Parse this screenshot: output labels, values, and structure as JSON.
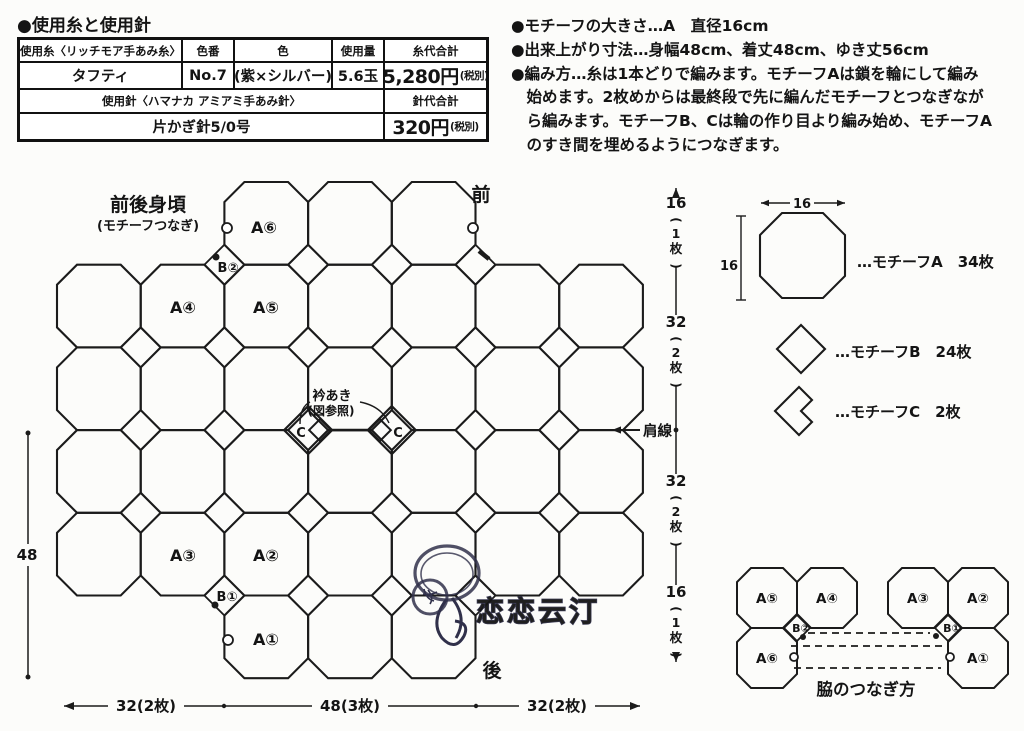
{
  "materials": {
    "title": "●使用糸と使用針",
    "headers": [
      "使用糸〈リッチモア手あみ糸〉",
      "色番",
      "色",
      "使用量",
      "糸代合計"
    ],
    "yarn": {
      "name": "タフティ",
      "color_no": "No.7",
      "color": "(紫×シルバー)",
      "amount": "5.6玉",
      "cost": "5,280円",
      "cost_note": "(税別)"
    },
    "needle": {
      "header": "使用針〈ハマナカ アミアミ手あみ針〉",
      "cost_header": "針代合計",
      "name": "片かぎ針5/0号",
      "cost": "320円",
      "cost_note": "(税別)"
    }
  },
  "notes": {
    "lines": [
      "●モチーフの大きさ…A　直径16cm",
      "●出来上がり寸法…身幅48cm、着丈48cm、ゆき丈56cm",
      "●編み方…糸は1本どりで編みます。モチーフAは鎖を輪にして編み",
      "　始めます。2枚めからは最終段で先に編んだモチーフとつなぎなが",
      "　ら編みます。モチーフB、Cは輪の作り目より編み始め、モチーフA",
      "　のすき間を埋めるようにつなぎます。"
    ]
  },
  "diagram": {
    "grid": {
      "x0": 57,
      "y0": 182,
      "cw": 83.7,
      "rh": 82.7,
      "cut": 20
    },
    "rows": [
      {
        "r": 1,
        "cols": [
          3,
          4,
          5
        ]
      },
      {
        "r": 2,
        "cols": [
          1,
          2,
          3,
          4,
          5,
          6,
          7
        ]
      },
      {
        "r": 3,
        "cols": [
          1,
          2,
          3,
          4,
          5,
          6,
          7
        ]
      },
      {
        "r": 4,
        "cols": [
          1,
          2,
          3,
          4,
          5,
          6,
          7
        ]
      },
      {
        "r": 5,
        "cols": [
          1,
          2,
          3,
          4,
          5,
          6,
          7
        ]
      },
      {
        "r": 6,
        "cols": [
          3,
          4,
          5
        ]
      }
    ],
    "b_diamonds": [
      [
        2,
        1
      ],
      [
        3,
        1
      ],
      [
        4,
        1
      ],
      [
        5,
        1
      ],
      [
        1,
        2
      ],
      [
        2,
        2
      ],
      [
        3,
        2
      ],
      [
        4,
        2
      ],
      [
        5,
        2
      ],
      [
        6,
        2
      ],
      [
        1,
        3
      ],
      [
        2,
        3
      ],
      [
        5,
        3
      ],
      [
        6,
        3
      ],
      [
        1,
        4
      ],
      [
        2,
        4
      ],
      [
        3,
        4
      ],
      [
        4,
        4
      ],
      [
        5,
        4
      ],
      [
        6,
        4
      ],
      [
        2,
        5
      ],
      [
        3,
        5
      ],
      [
        4,
        5
      ],
      [
        5,
        5
      ]
    ],
    "c_motifs": {
      "junctions": [
        3,
        4
      ],
      "j": 3,
      "d": 24,
      "inner_d": 11
    },
    "texts": {
      "title": "前後身頃",
      "subtitle": "(モチーフつなぎ)",
      "front": "前",
      "back": "後",
      "neck": "衿あき",
      "neck_sub": "(図参照)",
      "shoulder": "肩線"
    },
    "motif_labels": [
      {
        "t": "A⑥",
        "x": 264,
        "y": 233,
        "s": 16
      },
      {
        "t": "B②",
        "x": 228,
        "y": 272,
        "s": 13
      },
      {
        "t": "A④",
        "x": 183,
        "y": 313,
        "s": 16
      },
      {
        "t": "A⑤",
        "x": 266,
        "y": 313,
        "s": 16
      },
      {
        "t": "C",
        "x": 301,
        "y": 437,
        "s": 13
      },
      {
        "t": "C",
        "x": 398,
        "y": 437,
        "s": 13
      },
      {
        "t": "A③",
        "x": 183,
        "y": 561,
        "s": 16
      },
      {
        "t": "A②",
        "x": 266,
        "y": 561,
        "s": 16
      },
      {
        "t": "B①",
        "x": 227,
        "y": 601,
        "s": 13
      },
      {
        "t": "A①",
        "x": 266,
        "y": 645,
        "s": 16
      }
    ],
    "markers": {
      "circles": [
        [
          227,
          228
        ],
        [
          473,
          228
        ],
        [
          228,
          640
        ]
      ],
      "dots": [
        [
          216,
          257
        ],
        [
          215,
          605
        ]
      ],
      "tick": [
        479,
        251,
        489,
        259
      ]
    }
  },
  "dims": {
    "left": {
      "label": "48",
      "x": 28,
      "y1": 433,
      "y2": 677,
      "label_y": 560
    },
    "bottom": {
      "y": 706,
      "x1": 64,
      "x2": 640,
      "ticks": [
        224,
        476
      ],
      "labels": [
        {
          "t": "32(2枚)",
          "x": 146
        },
        {
          "t": "48(3枚)",
          "x": 350
        },
        {
          "t": "32(2枚)",
          "x": 557
        }
      ]
    },
    "right": {
      "x": 676,
      "y1": 188,
      "y2": 662,
      "dot_y": 430,
      "labels": [
        {
          "value": "16",
          "pieces": "1枚",
          "cy": 226
        },
        {
          "value": "32",
          "pieces": "2枚",
          "cy": 345
        },
        {
          "value": "32",
          "pieces": "2枚",
          "cy": 504
        },
        {
          "value": "16",
          "pieces": "1枚",
          "cy": 615
        }
      ]
    }
  },
  "legend": {
    "h_dim": "16",
    "v_dim": "16",
    "items": [
      {
        "prefix": "…",
        "name": "モチーフA",
        "count": "34枚",
        "x": 857,
        "y": 267
      },
      {
        "prefix": "…",
        "name": "モチーフB",
        "count": "24枚",
        "x": 835,
        "y": 357
      },
      {
        "prefix": "…",
        "name": "モチーフC",
        "count": "2枚",
        "x": 835,
        "y": 417
      }
    ]
  },
  "side_join": {
    "title": "脇のつなぎ方",
    "groups": [
      {
        "x0": 737,
        "y0": 568,
        "cell": 60,
        "cells": [
          {
            "t": "A⑤",
            "c": 0,
            "r": 0
          },
          {
            "t": "A④",
            "c": 1,
            "r": 0
          },
          {
            "t": "A⑥",
            "c": 0,
            "r": 1
          }
        ],
        "b_label": "B②",
        "dot": [
          803,
          637
        ],
        "circle": [
          794,
          657
        ]
      },
      {
        "x0": 888,
        "y0": 568,
        "cell": 60,
        "cells": [
          {
            "t": "A③",
            "c": 0,
            "r": 0
          },
          {
            "t": "A②",
            "c": 1,
            "r": 0
          },
          {
            "t": "A①",
            "c": 1,
            "r": 1
          }
        ],
        "b_label": "B①",
        "dot": [
          936,
          636
        ],
        "circle": [
          950,
          657
        ]
      }
    ],
    "dashed_lines": [
      [
        808,
        633,
        930,
        633
      ],
      [
        791,
        646,
        947,
        646
      ],
      [
        794,
        668,
        941,
        668
      ]
    ]
  },
  "watermark": {
    "text": "恋恋云汀"
  }
}
